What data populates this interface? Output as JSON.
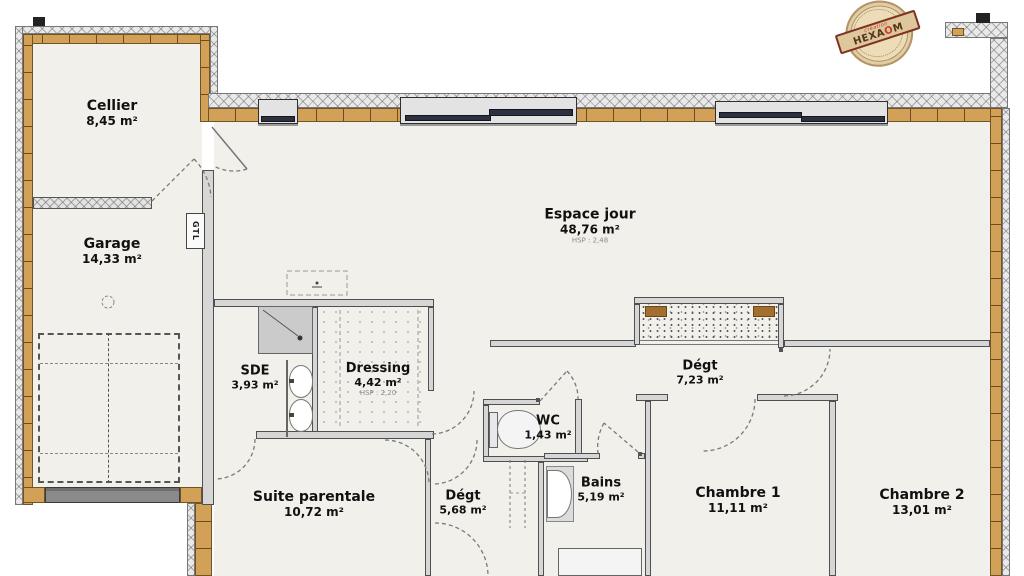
{
  "title": "Plan de rez-de-chaussée",
  "rooms": [
    {
      "id": "cellier",
      "name": "Cellier",
      "area": "8,45 m²"
    },
    {
      "id": "garage",
      "name": "Garage",
      "area": "14,33 m²"
    },
    {
      "id": "espace-jour",
      "name": "Espace jour",
      "area": "48,76 m²",
      "hsp": "HSP : 2,48"
    },
    {
      "id": "sde",
      "name": "SDE",
      "area": "3,93 m²"
    },
    {
      "id": "dressing",
      "name": "Dressing",
      "area": "4,42 m²",
      "hsp": "HSP : 2,20"
    },
    {
      "id": "wc",
      "name": "WC",
      "area": "1,43 m²"
    },
    {
      "id": "degagement-nord",
      "name": "Dégt",
      "area": "7,23 m²"
    },
    {
      "id": "bains",
      "name": "Bains",
      "area": "5,19 m²"
    },
    {
      "id": "suite-parentale",
      "name": "Suite parentale",
      "area": "10,72 m²"
    },
    {
      "id": "degagement-sud",
      "name": "Dégt",
      "area": "5,68 m²"
    },
    {
      "id": "chambre-1",
      "name": "Chambre 1",
      "area": "11,11 m²"
    },
    {
      "id": "chambre-2",
      "name": "Chambre 2",
      "area": "13,01 m²"
    }
  ],
  "labels": {
    "gtl": "GTL"
  },
  "stamp": {
    "tagline": "création",
    "brand_pre": "HEXA",
    "brand_o": "O",
    "brand_post": "M"
  },
  "fixtures": [
    "shower",
    "double-washbasin",
    "toilet",
    "washbasin",
    "bathtub",
    "parking-space",
    "gtl-duct"
  ],
  "colors": {
    "wall_wood": "#d3a057",
    "wall_cladding": "#e9e9e9",
    "interior_wall": "#d6d6d6",
    "window_glass": "#e3e3e3",
    "window_panel": "#2c3040",
    "garage_door": "#8a8a8a",
    "floor": "#f1f0ea",
    "stamp_red": "#c23b2b",
    "stamp_tan": "#ecdcb8",
    "text": "#111111"
  }
}
